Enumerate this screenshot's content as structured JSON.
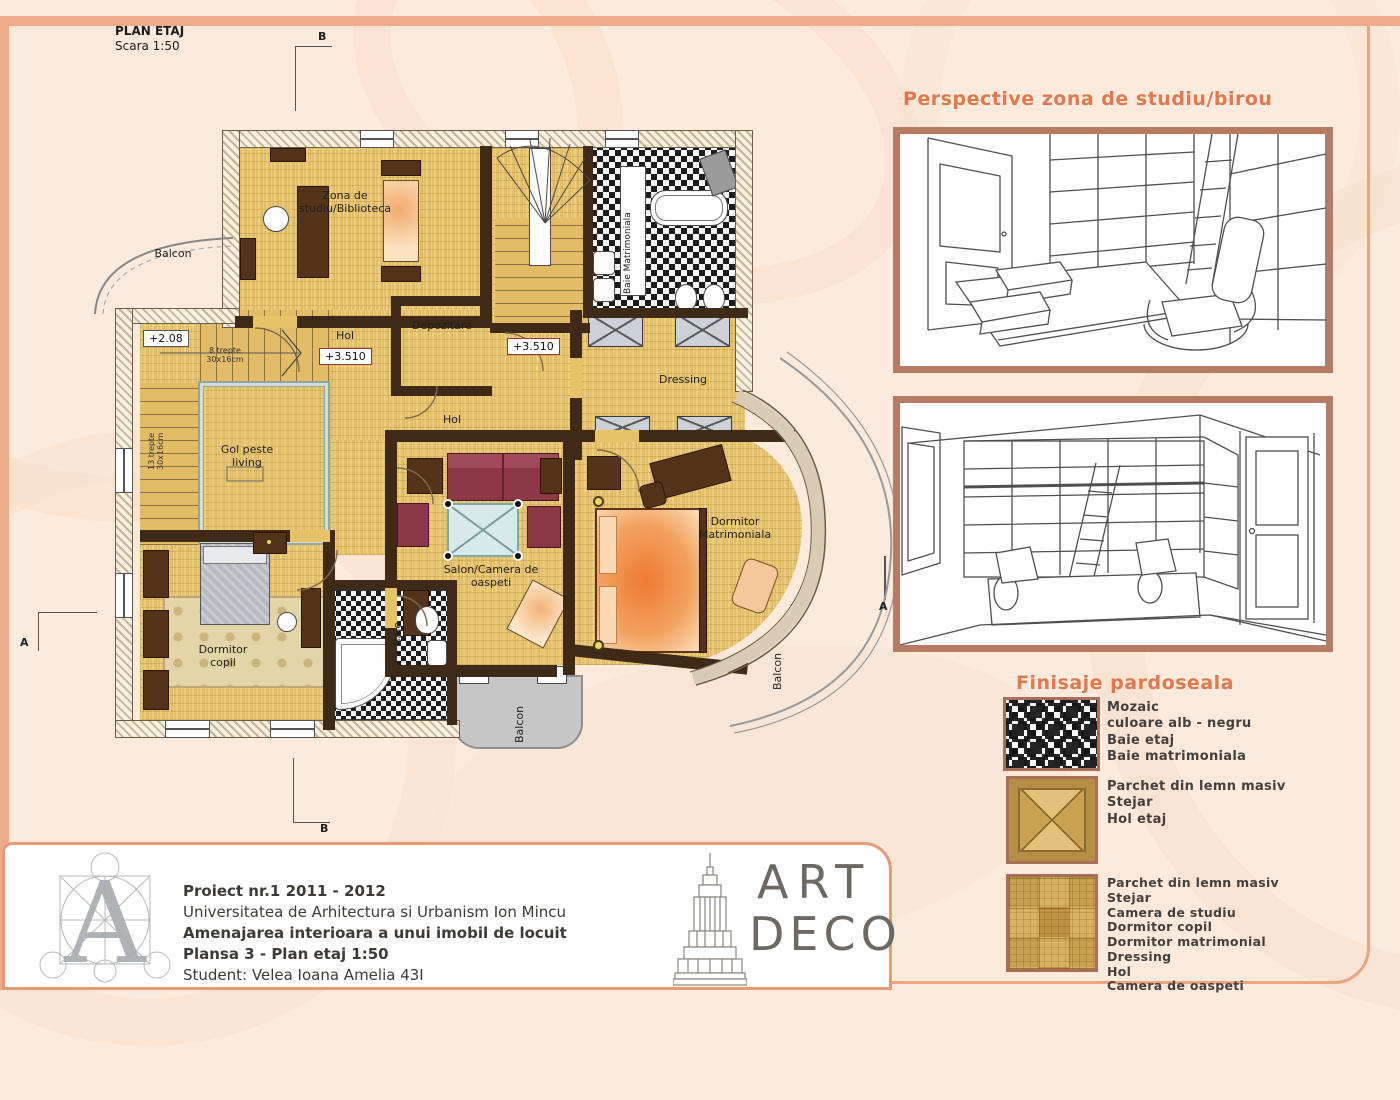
{
  "plan": {
    "title": "PLAN ETAJ",
    "scale": "Scara 1:50",
    "rooms": {
      "study": "Zona de studiu/Biblioteca",
      "depozitare": "Depozitare",
      "hol_a": "Hol",
      "hol_b": "Hol",
      "dressing": "Dressing",
      "gol": "Gol peste living",
      "baie_matrimoniala": "Baie Matrimoniala",
      "dormitor_matrimoniala": "Dormitor Matrimoniala",
      "salon": "Salon/Camera de oaspeti",
      "dormitor_copil": "Dormitor copil",
      "baie": "Baie",
      "balcon_left": "Balcon",
      "balcon_bottom": "Balcon",
      "balcon_right": "Balcon"
    },
    "levels": {
      "l208": "+2.08",
      "l3510_a": "+3.510",
      "l3510_b": "+3.510"
    },
    "stairs": {
      "s8": "8 trepte 30x16cm",
      "s13": "13 trepte 30x16cm"
    },
    "sections": {
      "a_left": "A",
      "a_right": "A",
      "b_top": "B",
      "b_bottom": "B"
    }
  },
  "perspectives": {
    "heading": "Perspective zona de studiu/birou"
  },
  "finishes": {
    "heading": "Finisaje pardoseala",
    "items": [
      {
        "lines": [
          "Mozaic",
          "culoare alb - negru",
          "Baie etaj",
          "Baie matrimoniala"
        ]
      },
      {
        "lines": [
          "Parchet din lemn masiv",
          "Stejar",
          "Hol etaj"
        ]
      },
      {
        "lines": [
          "Parchet din lemn masiv",
          "Stejar",
          "Camera de studiu",
          "Dormitor copil",
          "Dormitor matrimonial",
          "Dressing",
          "Hol",
          "Camera de oaspeti"
        ]
      }
    ]
  },
  "titleblock": {
    "line1": "Proiect nr.1 2011 - 2012",
    "line2": "Universitatea de Arhitectura si Urbanism Ion Mincu",
    "line3": "Amenajarea interioara a unui imobil de locuit",
    "line4": "Plansa 3 - Plan etaj 1:50",
    "line5": "Student: Velea Ioana Amelia 43I"
  },
  "brand": {
    "art": "ART",
    "deco": "DECO"
  },
  "colors": {
    "accent_heading": "#e0794e",
    "sheet_border": "#eaa47e",
    "frame_brown": "#b67c63",
    "parquet": "#e5c06a",
    "wall_dark": "#3f2a17",
    "background": "#fcebdd"
  }
}
